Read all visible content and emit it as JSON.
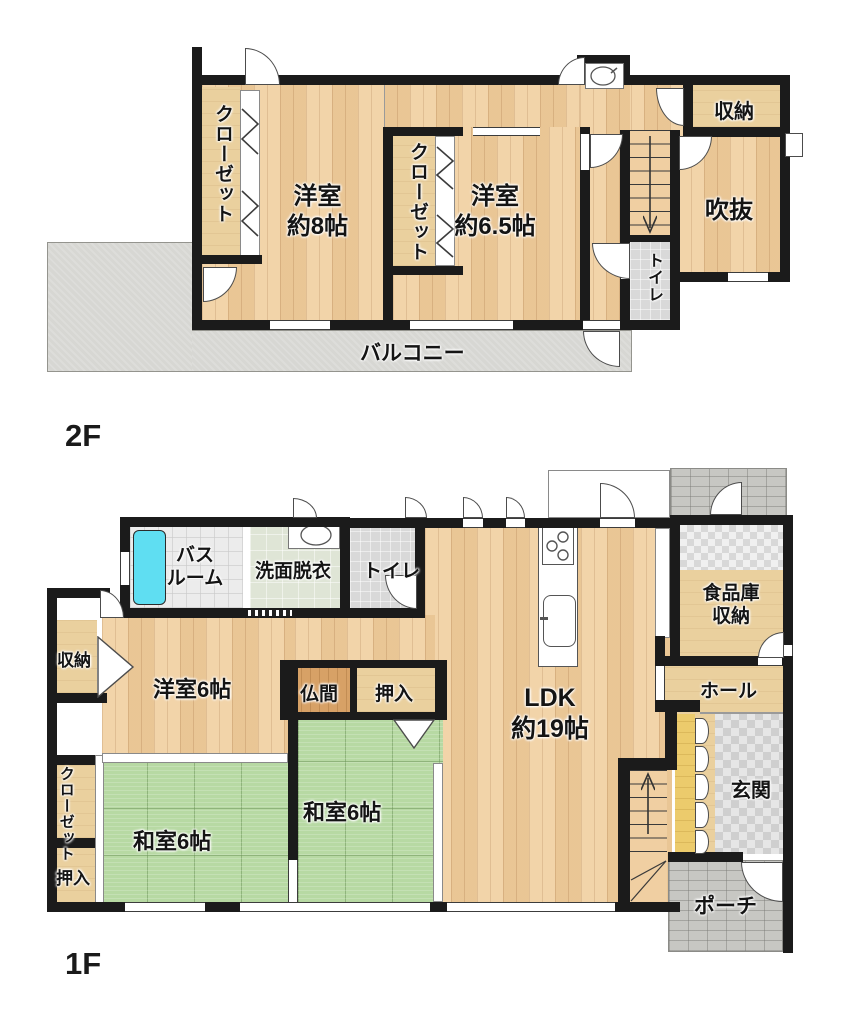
{
  "floor2": {
    "label": "2F",
    "balcony": "バルコニー",
    "closet_left": "クローゼット",
    "closet_mid": "クローゼット",
    "bedroom8": [
      "洋室",
      "約8帖"
    ],
    "bedroom65": [
      "洋室",
      "約6.5帖"
    ],
    "storage": "収納",
    "void_room": "吹抜",
    "toilet": "トイレ"
  },
  "floor1": {
    "label": "1F",
    "bath": [
      "バス",
      "ルーム"
    ],
    "washroom": "洗面脱衣",
    "toilet": "トイレ",
    "storage": "収納",
    "bedroom6": "洋室6帖",
    "butsuma": "仏間",
    "oshiire_top": "押入",
    "ldk": [
      "LDK",
      "約19帖"
    ],
    "pantry": [
      "食品庫",
      "収納"
    ],
    "hall": "ホール",
    "genkan": "玄関",
    "closet": "クローゼット",
    "oshiire_left": "押入",
    "washitsu_left": "和室6帖",
    "washitsu_right": "和室6帖",
    "porch": "ポーチ"
  },
  "icons": {
    "stair_down": "down-arrow",
    "stair_up": "up-arrow"
  },
  "colors": {
    "wall": "#1b1b1b",
    "wood_floor": "#f1cf9f",
    "tatami": "#b7d9a3",
    "bathtub": "#5fdef2",
    "shoe_cabinet": "#eccb6c",
    "balcony": "#d7d7d3",
    "altar_floor": "#d7a166"
  }
}
